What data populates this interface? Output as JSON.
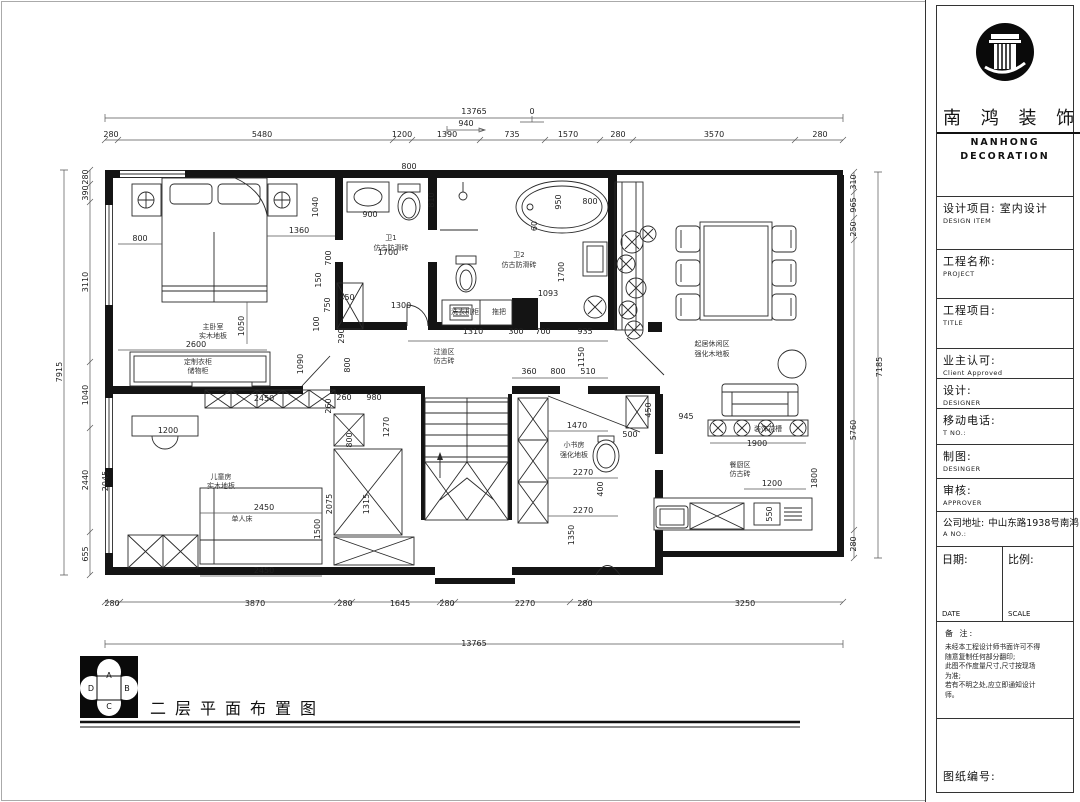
{
  "title_block": {
    "company_cn": "南 鸿 装 饰",
    "company_en_1": "NANHONG",
    "company_en_2": "DECORATION",
    "fields": [
      {
        "label": "设计项目:",
        "sub": "DESIGN ITEM",
        "value": "室内设计"
      },
      {
        "label": "工程名称:",
        "sub": "PROJECT",
        "value": ""
      },
      {
        "label": "工程项目:",
        "sub": "TITLE",
        "value": ""
      },
      {
        "label": "业主认可:",
        "sub": "Client Approved",
        "value": ""
      },
      {
        "label": "设计:",
        "sub": "DESIGNER",
        "value": ""
      },
      {
        "label": "移动电话:",
        "sub": "T NO.:",
        "value": ""
      },
      {
        "label": "制图:",
        "sub": "DESINGER",
        "value": ""
      },
      {
        "label": "审核:",
        "sub": "APPROVER",
        "value": ""
      },
      {
        "label": "公司地址:",
        "sub": "A NO.:",
        "value": "中山东路1938号南鸿"
      }
    ],
    "date_label": "日期:",
    "date_sub": "DATE",
    "scale_label": "比例:",
    "scale_sub": "SCALE",
    "notes_title": "备 注:",
    "notes": [
      "未经本工程设计师书面许可不得",
      "随意复制任何部分翻印;",
      "此图不作度量尺寸,尺寸按现场",
      "为准;",
      "若有不明之处,应立即通知设计",
      "师。"
    ],
    "drawing_no_label": "图纸编号:"
  },
  "footer": {
    "title": "二层平面布置图",
    "compass": {
      "top": "A",
      "right": "B",
      "bottom": "C",
      "left": "D"
    }
  },
  "plan": {
    "dim_labels": [
      {
        "t": "13765",
        "x": 474,
        "y": 114
      },
      {
        "t": "280",
        "x": 111,
        "y": 137
      },
      {
        "t": "5480",
        "x": 262,
        "y": 137
      },
      {
        "t": "1200",
        "x": 402,
        "y": 137
      },
      {
        "t": "1390",
        "x": 447,
        "y": 137
      },
      {
        "t": "940",
        "x": 466,
        "y": 126
      },
      {
        "t": "735",
        "x": 512,
        "y": 137
      },
      {
        "t": "1570",
        "x": 568,
        "y": 137
      },
      {
        "t": "280",
        "x": 618,
        "y": 137
      },
      {
        "t": "3570",
        "x": 714,
        "y": 137
      },
      {
        "t": "280",
        "x": 820,
        "y": 137
      },
      {
        "t": "0",
        "x": 532,
        "y": 114
      },
      {
        "t": "280",
        "x": 112,
        "y": 606
      },
      {
        "t": "3870",
        "x": 255,
        "y": 606
      },
      {
        "t": "280",
        "x": 345,
        "y": 606
      },
      {
        "t": "1645",
        "x": 400,
        "y": 606
      },
      {
        "t": "280",
        "x": 447,
        "y": 606
      },
      {
        "t": "2270",
        "x": 525,
        "y": 606
      },
      {
        "t": "280",
        "x": 585,
        "y": 606
      },
      {
        "t": "3250",
        "x": 745,
        "y": 606
      },
      {
        "t": "13765",
        "x": 474,
        "y": 646
      },
      {
        "t": "7915",
        "x": 62,
        "y": 372,
        "r": -90
      },
      {
        "t": "280",
        "x": 88,
        "y": 177,
        "r": -90
      },
      {
        "t": "390",
        "x": 88,
        "y": 193,
        "r": -90
      },
      {
        "t": "3110",
        "x": 88,
        "y": 282,
        "r": -90
      },
      {
        "t": "1040",
        "x": 88,
        "y": 395,
        "r": -90
      },
      {
        "t": "2440",
        "x": 88,
        "y": 480,
        "r": -90
      },
      {
        "t": "655",
        "x": 88,
        "y": 554,
        "r": -90
      },
      {
        "t": "7185",
        "x": 882,
        "y": 367,
        "r": -90
      },
      {
        "t": "310",
        "x": 856,
        "y": 182,
        "r": -90
      },
      {
        "t": "965",
        "x": 856,
        "y": 205,
        "r": -90
      },
      {
        "t": "250",
        "x": 856,
        "y": 229,
        "r": -90
      },
      {
        "t": "5760",
        "x": 856,
        "y": 430,
        "r": -90
      },
      {
        "t": "280",
        "x": 856,
        "y": 544,
        "r": -90
      },
      {
        "t": "800",
        "x": 140,
        "y": 241
      },
      {
        "t": "1360",
        "x": 299,
        "y": 233
      },
      {
        "t": "1040",
        "x": 318,
        "y": 207,
        "r": -90
      },
      {
        "t": "700",
        "x": 331,
        "y": 258,
        "r": -90
      },
      {
        "t": "150",
        "x": 321,
        "y": 280,
        "r": -90
      },
      {
        "t": "750",
        "x": 330,
        "y": 305,
        "r": -90
      },
      {
        "t": "100",
        "x": 319,
        "y": 324,
        "r": -90
      },
      {
        "t": "450",
        "x": 347,
        "y": 300
      },
      {
        "t": "290",
        "x": 344,
        "y": 336,
        "r": -90
      },
      {
        "t": "800",
        "x": 350,
        "y": 365,
        "r": -90
      },
      {
        "t": "1050",
        "x": 244,
        "y": 326,
        "r": -90
      },
      {
        "t": "2600",
        "x": 196,
        "y": 347
      },
      {
        "t": "1090",
        "x": 303,
        "y": 364,
        "r": -90
      },
      {
        "t": "800",
        "x": 409,
        "y": 169
      },
      {
        "t": "900",
        "x": 370,
        "y": 217
      },
      {
        "t": "1700",
        "x": 388,
        "y": 255
      },
      {
        "t": "1300",
        "x": 401,
        "y": 308
      },
      {
        "t": "810",
        "x": 434,
        "y": 200,
        "r": -90
      },
      {
        "t": "950",
        "x": 561,
        "y": 202,
        "r": -90
      },
      {
        "t": "800",
        "x": 590,
        "y": 204
      },
      {
        "t": "60",
        "x": 537,
        "y": 226,
        "r": -90
      },
      {
        "t": "1093",
        "x": 548,
        "y": 296
      },
      {
        "t": "1700",
        "x": 564,
        "y": 272,
        "r": -90
      },
      {
        "t": "1310",
        "x": 473,
        "y": 334
      },
      {
        "t": "300",
        "x": 516,
        "y": 334
      },
      {
        "t": "700",
        "x": 543,
        "y": 334
      },
      {
        "t": "935",
        "x": 585,
        "y": 334
      },
      {
        "t": "1150",
        "x": 584,
        "y": 357,
        "r": -90
      },
      {
        "t": "360",
        "x": 529,
        "y": 374
      },
      {
        "t": "800",
        "x": 558,
        "y": 374
      },
      {
        "t": "510",
        "x": 588,
        "y": 374
      },
      {
        "t": "260",
        "x": 344,
        "y": 400
      },
      {
        "t": "980",
        "x": 374,
        "y": 400
      },
      {
        "t": "1270",
        "x": 389,
        "y": 427,
        "r": -90
      },
      {
        "t": "800",
        "x": 352,
        "y": 440,
        "r": -90
      },
      {
        "t": "1315",
        "x": 369,
        "y": 504,
        "r": -90
      },
      {
        "t": "450",
        "x": 651,
        "y": 410,
        "r": -90
      },
      {
        "t": "500",
        "x": 630,
        "y": 437
      },
      {
        "t": "945",
        "x": 686,
        "y": 419
      },
      {
        "t": "1470",
        "x": 577,
        "y": 428
      },
      {
        "t": "2270",
        "x": 583,
        "y": 475
      },
      {
        "t": "400",
        "x": 603,
        "y": 489,
        "r": -90
      },
      {
        "t": "2270",
        "x": 583,
        "y": 513
      },
      {
        "t": "1350",
        "x": 574,
        "y": 535,
        "r": -90
      },
      {
        "t": "1900",
        "x": 757,
        "y": 446
      },
      {
        "t": "1200",
        "x": 772,
        "y": 486
      },
      {
        "t": "1800",
        "x": 817,
        "y": 478,
        "r": -90
      },
      {
        "t": "550",
        "x": 772,
        "y": 514,
        "r": -90
      },
      {
        "t": "2450",
        "x": 264,
        "y": 401
      },
      {
        "t": "260",
        "x": 331,
        "y": 406,
        "r": -90
      },
      {
        "t": "1200",
        "x": 168,
        "y": 433
      },
      {
        "t": "2045",
        "x": 108,
        "y": 481,
        "r": -90
      },
      {
        "t": "2450",
        "x": 264,
        "y": 510
      },
      {
        "t": "1500",
        "x": 320,
        "y": 529,
        "r": -90
      },
      {
        "t": "2075",
        "x": 332,
        "y": 504,
        "r": -90
      },
      {
        "t": "2450",
        "x": 264,
        "y": 573
      }
    ],
    "room_labels": [
      {
        "t": "主卧室",
        "x": 213,
        "y": 329
      },
      {
        "t": "实木地板",
        "x": 213,
        "y": 338
      },
      {
        "t": "定制衣柜",
        "x": 198,
        "y": 364
      },
      {
        "t": "储物柜",
        "x": 198,
        "y": 373
      },
      {
        "t": "卫1",
        "x": 391,
        "y": 240
      },
      {
        "t": "仿古防滑砖",
        "x": 391,
        "y": 250
      },
      {
        "t": "卫2",
        "x": 519,
        "y": 257
      },
      {
        "t": "仿古防滑砖",
        "x": 519,
        "y": 267
      },
      {
        "t": "洗衣机柜",
        "x": 465,
        "y": 314
      },
      {
        "t": "拖把",
        "x": 499,
        "y": 314
      },
      {
        "t": "过道区",
        "x": 444,
        "y": 354
      },
      {
        "t": "仿古砖",
        "x": 444,
        "y": 363
      },
      {
        "t": "起居休闲区",
        "x": 712,
        "y": 346
      },
      {
        "t": "强化木地板",
        "x": 712,
        "y": 356
      },
      {
        "t": "装饰花槽",
        "x": 768,
        "y": 431
      },
      {
        "t": "餐厨区",
        "x": 740,
        "y": 467
      },
      {
        "t": "仿古砖",
        "x": 740,
        "y": 476
      },
      {
        "t": "小书房",
        "x": 574,
        "y": 447
      },
      {
        "t": "强化地板",
        "x": 574,
        "y": 457
      },
      {
        "t": "儿童房",
        "x": 221,
        "y": 479
      },
      {
        "t": "实木地板",
        "x": 221,
        "y": 488
      },
      {
        "t": "单人床",
        "x": 242,
        "y": 521
      }
    ]
  }
}
